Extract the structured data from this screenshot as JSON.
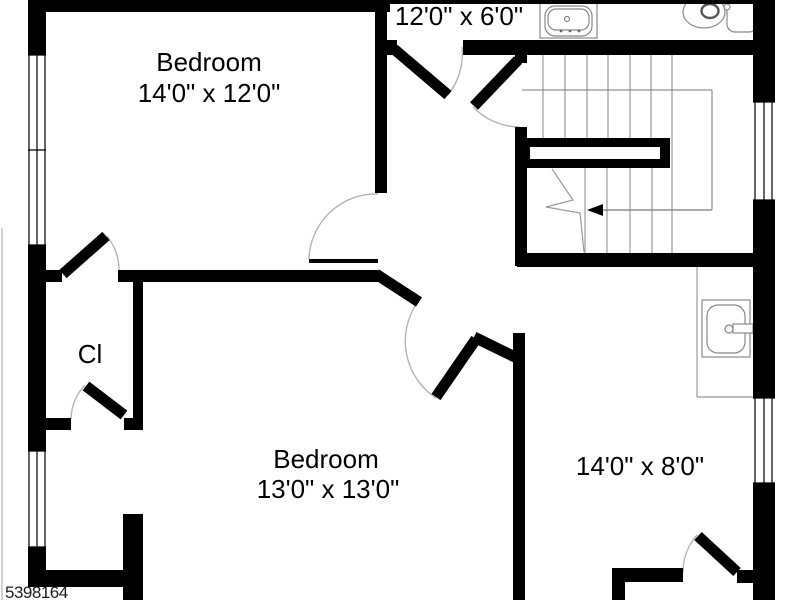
{
  "watermark": {
    "text": "5398164",
    "color": "#1c1c1c"
  },
  "labels": {
    "hall_dims": "12'0\" x 6'0\"",
    "bedroom_top_name": "Bedroom",
    "bedroom_top_dims": "14'0\" x 12'0\"",
    "closet": "Cl",
    "bedroom_bottom_name": "Bedroom",
    "bedroom_bottom_dims": "13'0\" x 13'0\"",
    "room_right_dims": "14'0\" x 8'0\""
  },
  "fixtures": {
    "top_bathroom": [
      "sink-vanity",
      "toilet"
    ],
    "side_bathroom": [
      "sink-vanity"
    ],
    "stairs": {
      "direction_arrow": "left",
      "treads_upper": 7,
      "treads_lower": 4
    }
  },
  "colors": {
    "wall": "#000000",
    "background": "#ffffff",
    "thin_line": "#999999",
    "arc": "#b3b3b3",
    "text": "#000000"
  }
}
